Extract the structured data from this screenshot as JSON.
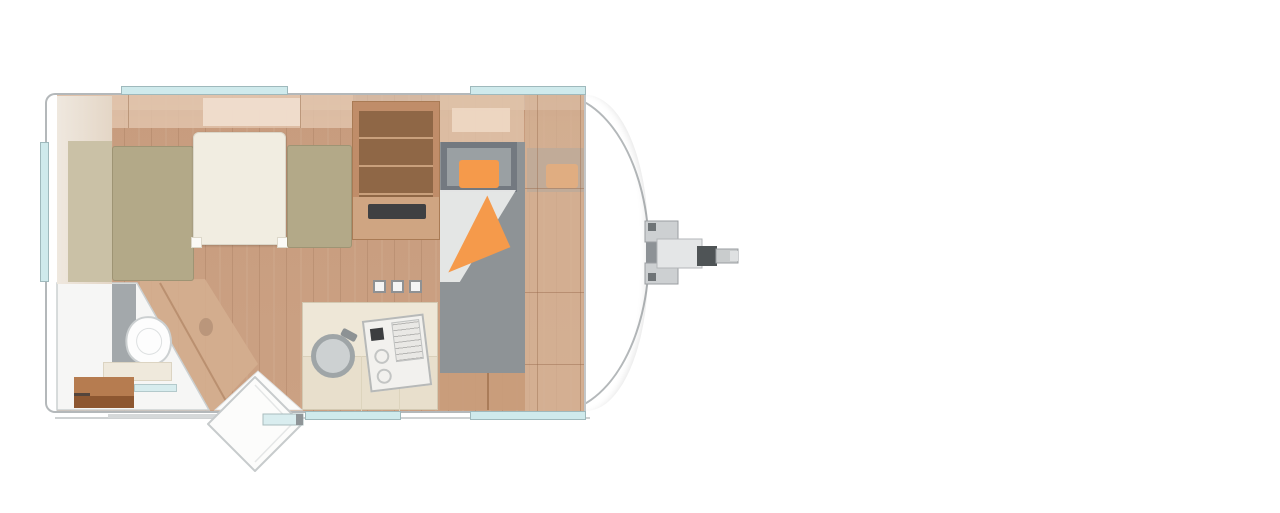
{
  "meta": {
    "title": "Caravan floor plan (top-down view) with tow hitch at front",
    "contains_text": false
  },
  "palette": {
    "body_border": "#b4b8ba",
    "window": "#cfeaec",
    "window_border": "#9fb9bc",
    "floor": "#c79c7e",
    "floor_light": "#d4ae8f",
    "mattress": "#b3a988",
    "mattress_pale": "#cac1a6",
    "duvet": "#f1ede1",
    "cabinet_wood": "#c08d69",
    "counter": "#eee7d7",
    "sink": "#cdd1d2",
    "bunk_grey": "#8e9396",
    "bunk_frame": "#737980",
    "orange": "#f59a4b",
    "bathroom": "#f6f6f5",
    "bench": "#b67c50",
    "bench_front": "#8d5731",
    "slot_dark": "#3f4042",
    "hitch_grey": "#8d9296",
    "hitch_light": "#cdd0d2",
    "hitch_dark": "#4f5456"
  },
  "labels": {
    "canvas": "caravan floor plan",
    "shell": "caravan body outline",
    "bedroom": "rear bedroom with double bed and duvet",
    "bathroom": "corner bathroom with toilet and bench",
    "kitchen": "kitchen block with round sink and stove",
    "tall_cabinet": "tall shelved cabinet",
    "bunks": "front transverse bunk beds with orange pillows and blanket",
    "wardrobe": "front wardrobe column (semi-transparent overlay)",
    "door": "entry door shown open below the side wall",
    "hitch": "tow hitch and coupling at caravan front",
    "windows": "five light-blue window strips in walls"
  },
  "counts": {
    "window_strips": 5,
    "pillows": 2,
    "stove_knobs": 3
  }
}
